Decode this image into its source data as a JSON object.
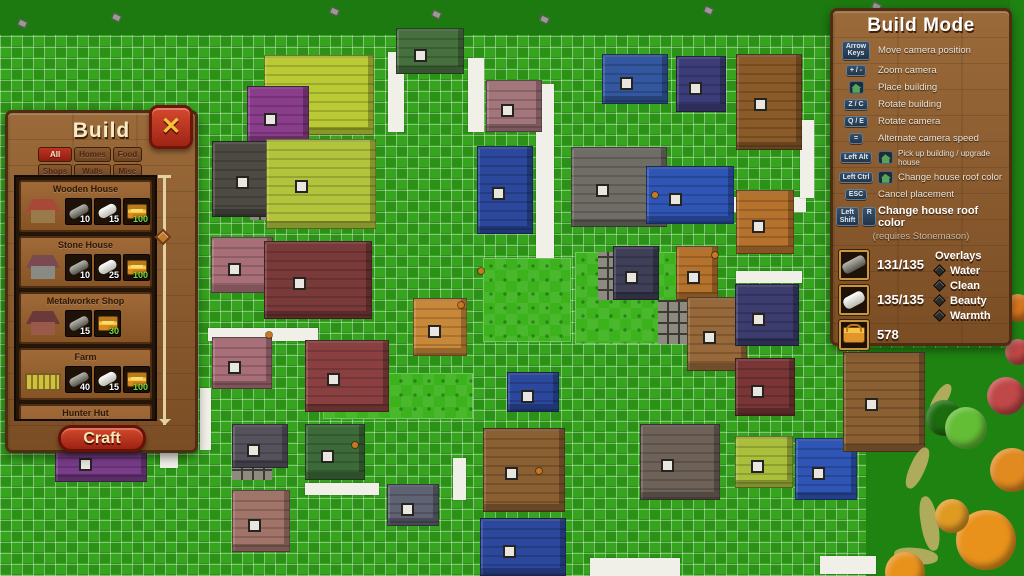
{
  "build_panel": {
    "title": "Build",
    "close_label": "✕",
    "tabs": [
      {
        "label": "All",
        "active": true
      },
      {
        "label": "Homes",
        "active": false
      },
      {
        "label": "Food",
        "active": false
      },
      {
        "label": "Shops",
        "active": false
      },
      {
        "label": "Walls",
        "active": false
      },
      {
        "label": "Misc",
        "active": false
      }
    ],
    "items": [
      {
        "name": "Wooden House",
        "thumb": "wooden-house",
        "roof": "#a84838",
        "body": "#9a7a4a",
        "costs": [
          {
            "icon": "log",
            "value": "10"
          },
          {
            "icon": "stone",
            "value": "15"
          },
          {
            "icon": "chest",
            "value": "100"
          }
        ]
      },
      {
        "name": "Stone House",
        "thumb": "stone-house",
        "roof": "#7a4a50",
        "body": "#8a8a84",
        "costs": [
          {
            "icon": "log",
            "value": "10"
          },
          {
            "icon": "stone",
            "value": "25"
          },
          {
            "icon": "chest",
            "value": "100"
          }
        ]
      },
      {
        "name": "Metalworker Shop",
        "thumb": "metalworker-shop",
        "roof": "#6a3a3a",
        "body": "#9a5a4a",
        "costs": [
          {
            "icon": "log",
            "value": "15"
          },
          {
            "icon": "chest",
            "value": "30"
          }
        ]
      },
      {
        "name": "Farm",
        "thumb": "farm",
        "roof": "",
        "body": "",
        "costs": [
          {
            "icon": "log",
            "value": "40"
          },
          {
            "icon": "stone",
            "value": "15"
          },
          {
            "icon": "chest",
            "value": "100"
          }
        ]
      },
      {
        "name": "Hunter Hut",
        "thumb": "hunter-hut",
        "roof": "#5a4a32",
        "body": "#7a6a4a",
        "costs": []
      }
    ],
    "craft_label": "Craft"
  },
  "build_mode_panel": {
    "title": "Build Mode",
    "shortcuts": [
      {
        "keys": [
          "Arrow\nKeys"
        ],
        "house_icon": false,
        "label": "Move camera position",
        "size": "normal"
      },
      {
        "keys": [
          "+ / -"
        ],
        "house_icon": false,
        "label": "Zoom camera",
        "size": "normal"
      },
      {
        "keys": [],
        "house_icon": true,
        "label": "Place building",
        "size": "normal"
      },
      {
        "keys": [
          "Z / C"
        ],
        "house_icon": false,
        "label": "Rotate building",
        "size": "normal"
      },
      {
        "keys": [
          "Q / E"
        ],
        "house_icon": false,
        "label": "Rotate camera",
        "size": "normal"
      },
      {
        "keys": [
          "="
        ],
        "house_icon": false,
        "label": "Alternate camera speed",
        "size": "normal"
      },
      {
        "keys": [
          "Left Alt"
        ],
        "house_icon": true,
        "label": "Pick up building / upgrade house",
        "size": "small"
      },
      {
        "keys": [
          "Left Ctrl"
        ],
        "house_icon": true,
        "label": "Change house roof color",
        "size": "normal"
      },
      {
        "keys": [
          "ESC"
        ],
        "house_icon": false,
        "label": "Cancel placement",
        "size": "normal"
      },
      {
        "keys": [
          "Left\nShift",
          "R"
        ],
        "house_icon": false,
        "label": "Change house roof color",
        "size": "big"
      }
    ],
    "note": "(requires Stonemason)",
    "resources": [
      {
        "icon": "log",
        "value": "131/135"
      },
      {
        "icon": "stone",
        "value": "135/135"
      },
      {
        "icon": "basket",
        "value": "578"
      }
    ],
    "overlays": {
      "title": "Overlays",
      "options": [
        "Water",
        "Clean",
        "Beauty",
        "Warmth"
      ]
    }
  },
  "map": {
    "colors": {
      "outer": "#1d7a10",
      "plain": "#1f8312",
      "grid_light": "#36a41f",
      "grid_dark": "#2c9117",
      "road": "#f1f0e8",
      "field": "#3cb31d",
      "tiles": "#8d8b80",
      "path": "#c9b36a"
    },
    "grid": {
      "x": 0,
      "y": 35,
      "w": 1010,
      "h": 541,
      "cell": 11
    },
    "plain_rects": [
      {
        "x": 866,
        "y": 348,
        "w": 158,
        "h": 228
      },
      {
        "x": 1010,
        "y": 0,
        "w": 14,
        "h": 576
      }
    ],
    "roads": [
      {
        "x": 388,
        "y": 52,
        "w": 16,
        "h": 80
      },
      {
        "x": 468,
        "y": 58,
        "w": 16,
        "h": 74
      },
      {
        "x": 536,
        "y": 84,
        "w": 18,
        "h": 232
      },
      {
        "x": 574,
        "y": 197,
        "w": 232,
        "h": 15
      },
      {
        "x": 736,
        "y": 271,
        "w": 66,
        "h": 12
      },
      {
        "x": 800,
        "y": 120,
        "w": 14,
        "h": 78
      },
      {
        "x": 862,
        "y": 160,
        "w": 14,
        "h": 66
      },
      {
        "x": 208,
        "y": 328,
        "w": 110,
        "h": 13
      },
      {
        "x": 200,
        "y": 388,
        "w": 11,
        "h": 62
      },
      {
        "x": 305,
        "y": 483,
        "w": 74,
        "h": 12
      },
      {
        "x": 453,
        "y": 458,
        "w": 13,
        "h": 42
      },
      {
        "x": 590,
        "y": 558,
        "w": 90,
        "h": 18
      },
      {
        "x": 820,
        "y": 556,
        "w": 56,
        "h": 18
      },
      {
        "x": 160,
        "y": 438,
        "w": 18,
        "h": 30
      }
    ],
    "fields": [
      {
        "x": 483,
        "y": 258,
        "w": 88,
        "h": 84
      },
      {
        "x": 575,
        "y": 252,
        "w": 112,
        "h": 92
      },
      {
        "x": 323,
        "y": 373,
        "w": 150,
        "h": 46
      }
    ],
    "tile_patches": [
      {
        "x": 247,
        "y": 115,
        "w": 26,
        "h": 28
      },
      {
        "x": 250,
        "y": 190,
        "w": 26,
        "h": 30
      },
      {
        "x": 598,
        "y": 252,
        "w": 42,
        "h": 48
      },
      {
        "x": 658,
        "y": 300,
        "w": 32,
        "h": 44
      },
      {
        "x": 648,
        "y": 470,
        "w": 52,
        "h": 28
      },
      {
        "x": 232,
        "y": 462,
        "w": 40,
        "h": 18
      }
    ],
    "buildings": [
      {
        "x": 396,
        "y": 28,
        "w": 68,
        "h": 46,
        "c": "#47703f"
      },
      {
        "x": 264,
        "y": 55,
        "w": 110,
        "h": 80,
        "c": "#b9ca35"
      },
      {
        "x": 247,
        "y": 86,
        "w": 62,
        "h": 58,
        "c": "#8a3d8a"
      },
      {
        "x": 486,
        "y": 80,
        "w": 56,
        "h": 52,
        "c": "#a3767c"
      },
      {
        "x": 602,
        "y": 54,
        "w": 66,
        "h": 50,
        "c": "#33589f"
      },
      {
        "x": 676,
        "y": 56,
        "w": 50,
        "h": 56,
        "c": "#3c3c78"
      },
      {
        "x": 736,
        "y": 54,
        "w": 66,
        "h": 96,
        "c": "#8a5a28"
      },
      {
        "x": 212,
        "y": 141,
        "w": 92,
        "h": 76,
        "c": "#4c4a42"
      },
      {
        "x": 266,
        "y": 139,
        "w": 110,
        "h": 90,
        "c": "#b2c43c"
      },
      {
        "x": 477,
        "y": 146,
        "w": 56,
        "h": 88,
        "c": "#2c489c"
      },
      {
        "x": 571,
        "y": 147,
        "w": 96,
        "h": 80,
        "c": "#6f6d66"
      },
      {
        "x": 646,
        "y": 166,
        "w": 88,
        "h": 58,
        "c": "#2f55b5"
      },
      {
        "x": 876,
        "y": 160,
        "w": 66,
        "h": 66,
        "c": "#a3767c"
      },
      {
        "x": 736,
        "y": 190,
        "w": 58,
        "h": 64,
        "c": "#b5722c"
      },
      {
        "x": 211,
        "y": 237,
        "w": 62,
        "h": 56,
        "c": "#a86f78"
      },
      {
        "x": 264,
        "y": 241,
        "w": 108,
        "h": 78,
        "c": "#7a3a3a"
      },
      {
        "x": 613,
        "y": 246,
        "w": 46,
        "h": 54,
        "c": "#3f3f58"
      },
      {
        "x": 676,
        "y": 246,
        "w": 42,
        "h": 54,
        "c": "#b5722c"
      },
      {
        "x": 687,
        "y": 297,
        "w": 60,
        "h": 74,
        "c": "#96683a"
      },
      {
        "x": 735,
        "y": 284,
        "w": 64,
        "h": 62,
        "c": "#3c3c6e"
      },
      {
        "x": 413,
        "y": 298,
        "w": 54,
        "h": 58,
        "c": "#c8883a"
      },
      {
        "x": 212,
        "y": 337,
        "w": 60,
        "h": 52,
        "c": "#a86f78"
      },
      {
        "x": 305,
        "y": 340,
        "w": 84,
        "h": 72,
        "c": "#8a4040"
      },
      {
        "x": 507,
        "y": 372,
        "w": 52,
        "h": 40,
        "c": "#2c489c"
      },
      {
        "x": 232,
        "y": 424,
        "w": 56,
        "h": 44,
        "c": "#55525c"
      },
      {
        "x": 305,
        "y": 424,
        "w": 60,
        "h": 56,
        "c": "#3c6a38"
      },
      {
        "x": 232,
        "y": 490,
        "w": 58,
        "h": 62,
        "c": "#a07468"
      },
      {
        "x": 387,
        "y": 484,
        "w": 52,
        "h": 42,
        "c": "#5f6272"
      },
      {
        "x": 483,
        "y": 428,
        "w": 82,
        "h": 84,
        "c": "#8a5f32"
      },
      {
        "x": 480,
        "y": 518,
        "w": 86,
        "h": 58,
        "c": "#2c489c"
      },
      {
        "x": 735,
        "y": 358,
        "w": 60,
        "h": 58,
        "c": "#7a3636"
      },
      {
        "x": 640,
        "y": 424,
        "w": 80,
        "h": 76,
        "c": "#6e6258"
      },
      {
        "x": 735,
        "y": 436,
        "w": 58,
        "h": 52,
        "c": "#aabf3c"
      },
      {
        "x": 795,
        "y": 438,
        "w": 62,
        "h": 62,
        "c": "#2f55b5"
      },
      {
        "x": 843,
        "y": 352,
        "w": 82,
        "h": 100,
        "c": "#8a5f32"
      },
      {
        "x": 55,
        "y": 438,
        "w": 92,
        "h": 44,
        "c": "#7a3d8a"
      }
    ],
    "trees": [
      {
        "x": 944,
        "y": 418,
        "r": 18,
        "c": "#1c6b0e"
      },
      {
        "x": 966,
        "y": 428,
        "r": 21,
        "c": "#63bd35"
      },
      {
        "x": 1006,
        "y": 396,
        "r": 19,
        "c": "#c04848"
      },
      {
        "x": 1012,
        "y": 470,
        "r": 22,
        "c": "#e08a20"
      },
      {
        "x": 986,
        "y": 540,
        "r": 30,
        "c": "#e8921c"
      },
      {
        "x": 952,
        "y": 516,
        "r": 17,
        "c": "#df9a22"
      },
      {
        "x": 1018,
        "y": 308,
        "r": 14,
        "c": "#d87820"
      },
      {
        "x": 1018,
        "y": 352,
        "r": 13,
        "c": "#c04848"
      },
      {
        "x": 905,
        "y": 572,
        "r": 20,
        "c": "#e8921c"
      }
    ],
    "paths": [
      {
        "x": 910,
        "y": 446,
        "w": 15,
        "h": 44,
        "r": 24
      },
      {
        "x": 921,
        "y": 496,
        "w": 17,
        "h": 55,
        "r": -10
      },
      {
        "x": 894,
        "y": 548,
        "w": 44,
        "h": 16,
        "r": 6
      },
      {
        "x": 934,
        "y": 382,
        "w": 13,
        "h": 34,
        "r": 32
      }
    ],
    "debris": [
      {
        "x": 112,
        "y": 14
      },
      {
        "x": 330,
        "y": 8
      },
      {
        "x": 432,
        "y": 11
      },
      {
        "x": 704,
        "y": 7
      },
      {
        "x": 872,
        "y": 3
      },
      {
        "x": 540,
        "y": 16
      },
      {
        "x": 962,
        "y": 10
      },
      {
        "x": 18,
        "y": 20
      }
    ],
    "villagers": [
      {
        "x": 478,
        "y": 268
      },
      {
        "x": 458,
        "y": 302
      },
      {
        "x": 352,
        "y": 442
      },
      {
        "x": 536,
        "y": 468
      },
      {
        "x": 652,
        "y": 192
      },
      {
        "x": 712,
        "y": 252
      },
      {
        "x": 266,
        "y": 332
      }
    ]
  }
}
